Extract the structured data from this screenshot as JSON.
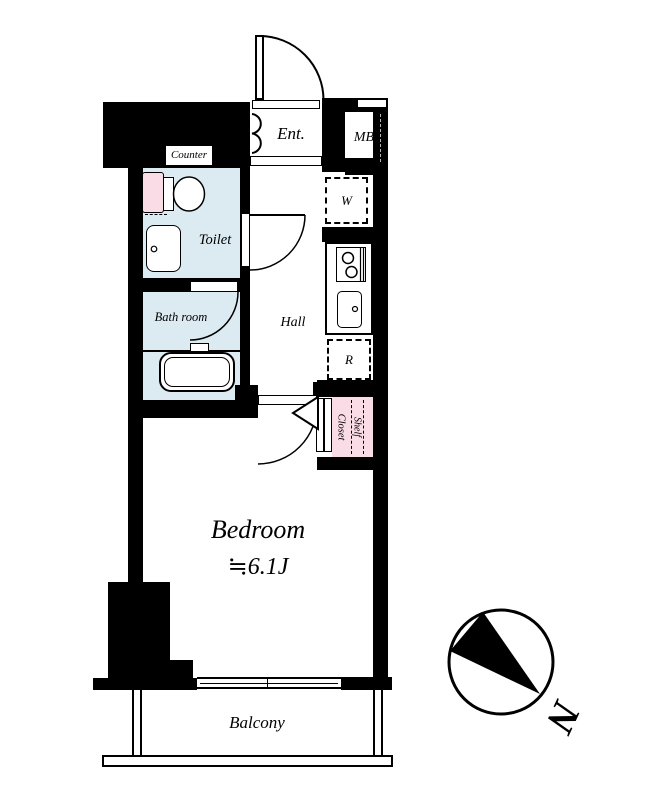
{
  "plan": {
    "entrance": {
      "label": "Ent."
    },
    "meter_box": {
      "label": "MB"
    },
    "shoes_closet": {
      "label": "Shoes Clo"
    },
    "counter": {
      "label": "Counter"
    },
    "toilet": {
      "label": "Toilet"
    },
    "washer_space": {
      "label": "W"
    },
    "fridge_space": {
      "label": "R"
    },
    "hall": {
      "label": "Hall"
    },
    "bathroom": {
      "label": "Bath room"
    },
    "closet": {
      "label": "Closet",
      "shelf_label": "Shelf"
    },
    "bedroom": {
      "label": "Bedroom",
      "size": "≒6.1J"
    },
    "balcony": {
      "label": "Balcony"
    }
  },
  "compass": {
    "north_label": "N"
  },
  "colors": {
    "wall": "#000000",
    "wet_area_fill": "#dcebf2",
    "storage_fill": "#f9dce6",
    "background": "#ffffff"
  }
}
